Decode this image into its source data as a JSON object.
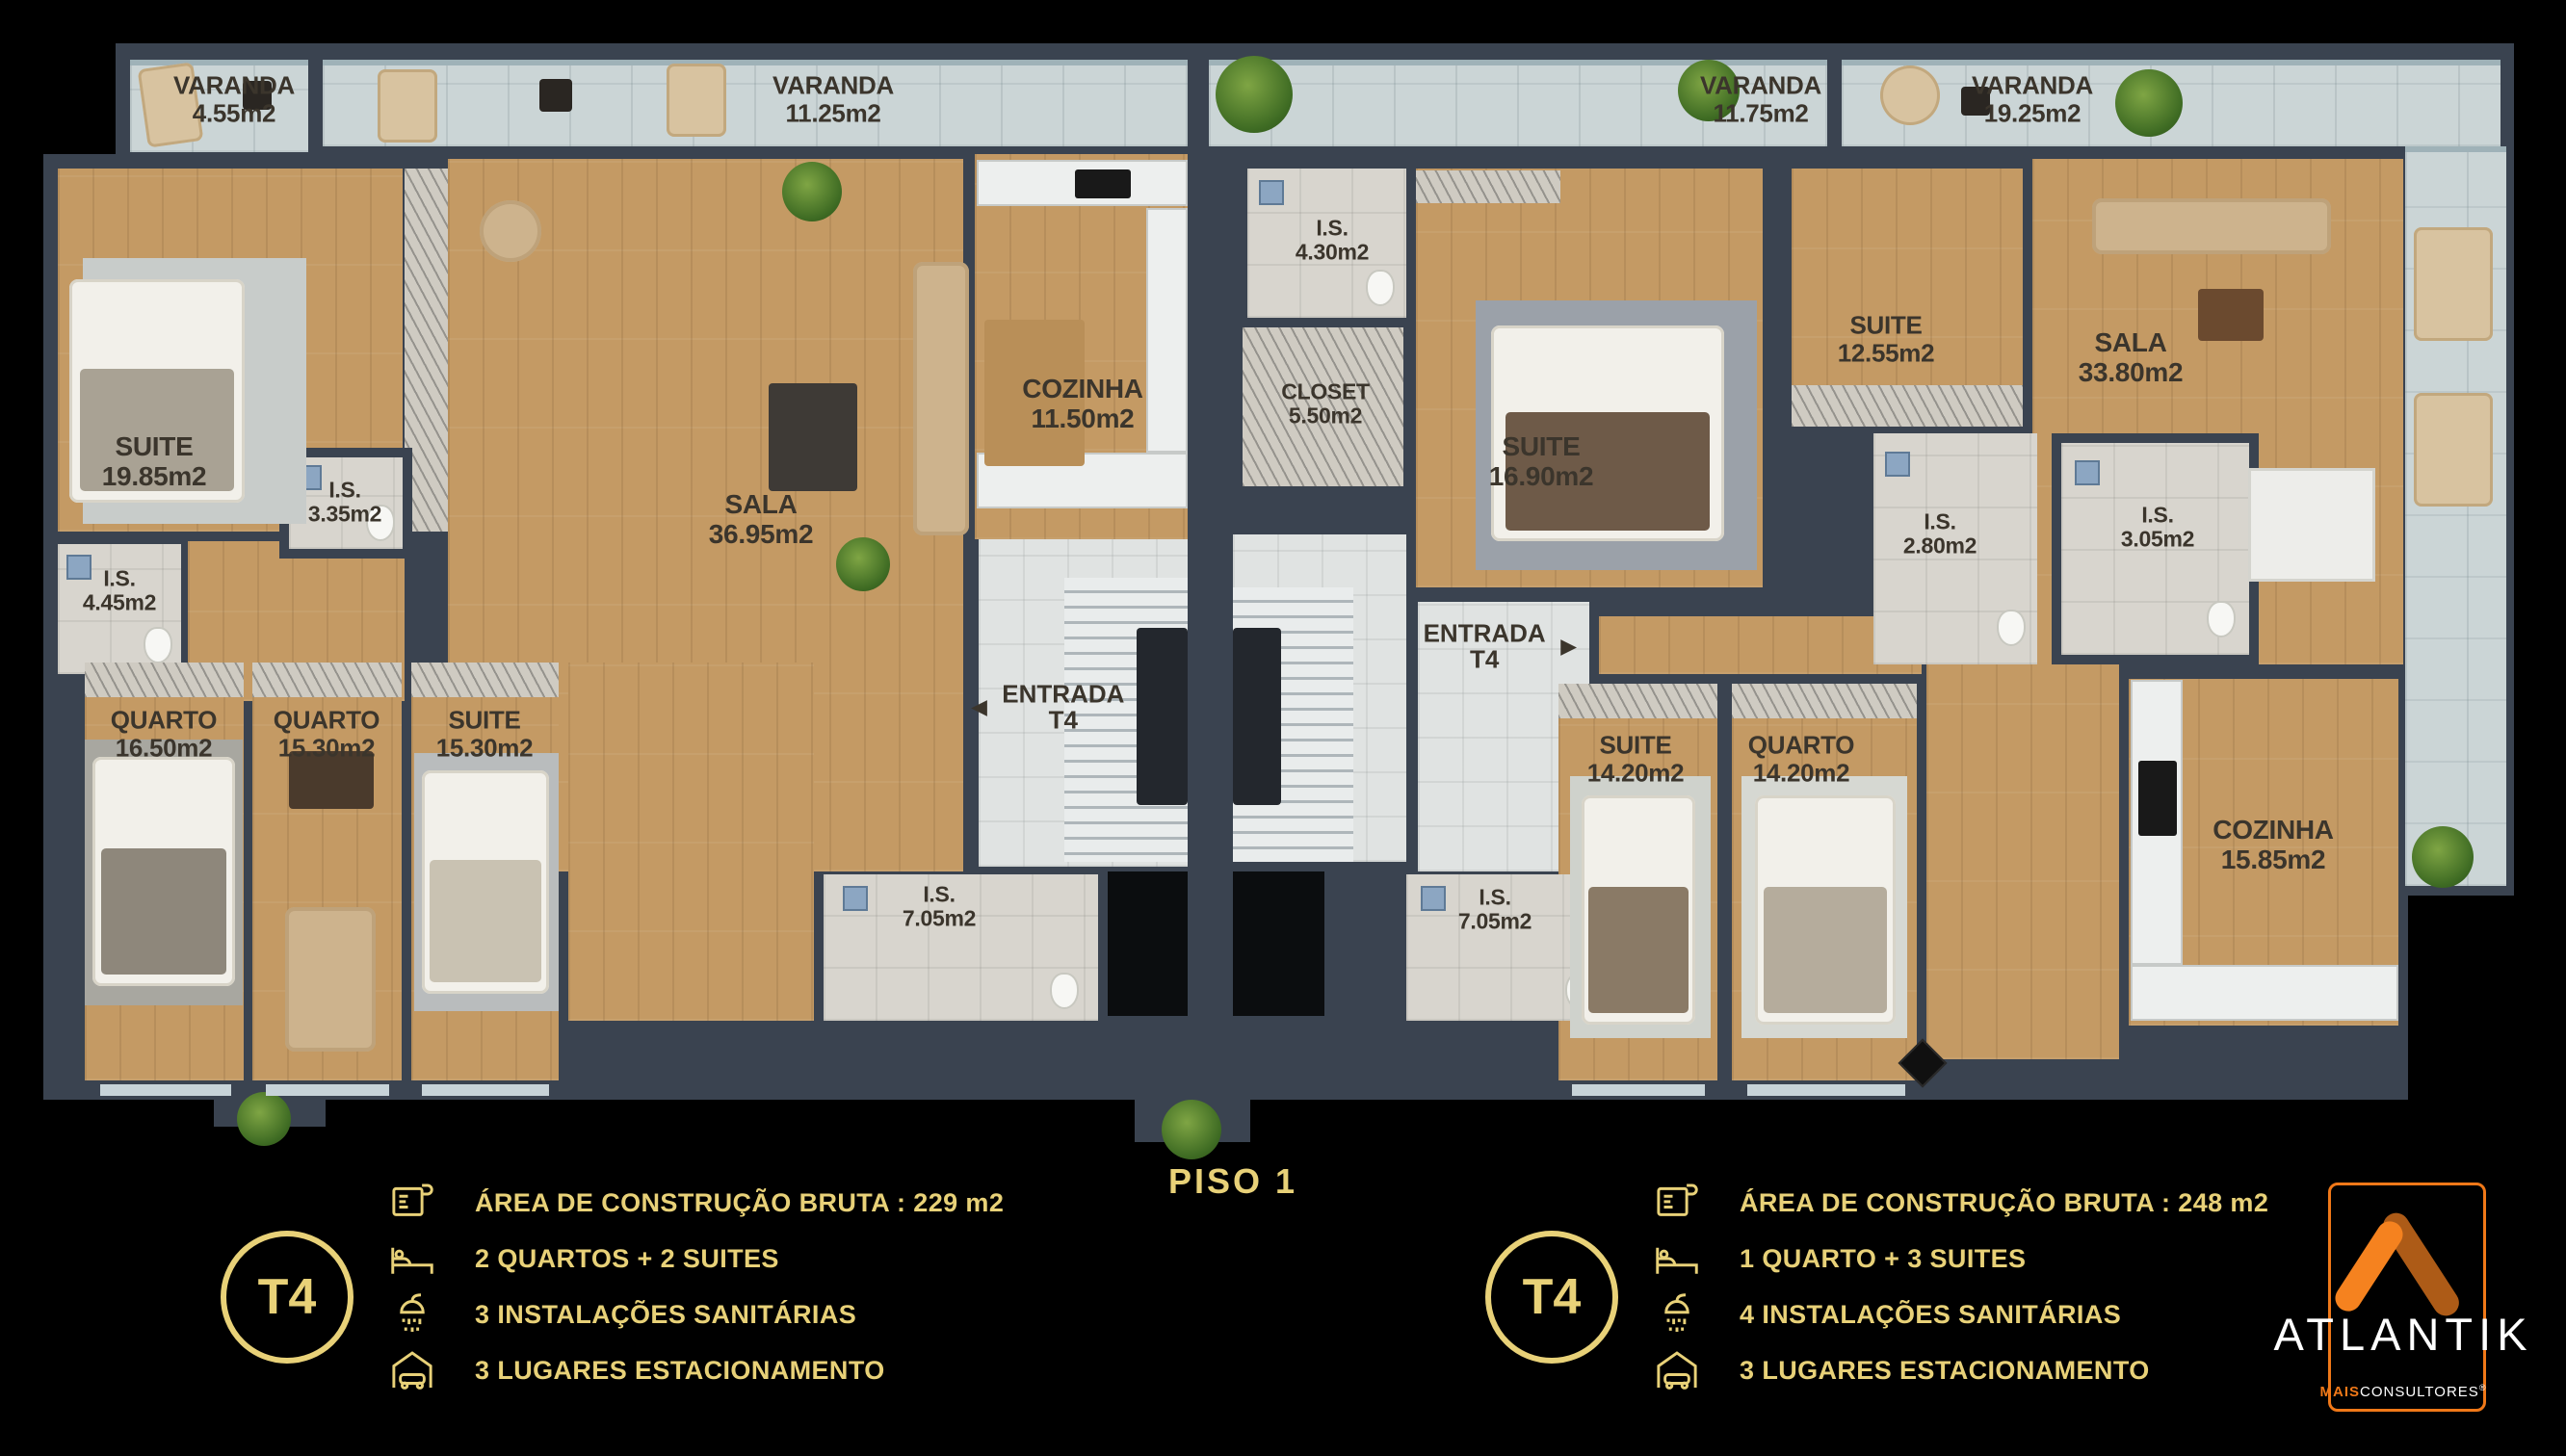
{
  "title": {
    "text": "PISO 1"
  },
  "colors": {
    "gold": "#E8D178",
    "orange": "#F07818",
    "wall": "#3A4350"
  },
  "rooms": [
    {
      "name": "VARANDA",
      "area": "4.55m2"
    },
    {
      "name": "VARANDA",
      "area": "11.25m2"
    },
    {
      "name": "SUITE",
      "area": "19.85m2"
    },
    {
      "name": "I.S.",
      "area": "4.45m2"
    },
    {
      "name": "I.S.",
      "area": "3.35m2"
    },
    {
      "name": "SALA",
      "area": "36.95m2"
    },
    {
      "name": "COZINHA",
      "area": "11.50m2"
    },
    {
      "name": "QUARTO",
      "area": "16.50m2"
    },
    {
      "name": "QUARTO",
      "area": "15.30m2"
    },
    {
      "name": "SUITE",
      "area": "15.30m2"
    },
    {
      "name": "I.S.",
      "area": "7.05m2"
    },
    {
      "name": "I.S.",
      "area": "4.30m2"
    },
    {
      "name": "CLOSET",
      "area": "5.50m2"
    },
    {
      "name": "SUITE",
      "area": "16.90m2"
    },
    {
      "name": "VARANDA",
      "area": "11.75m2"
    },
    {
      "name": "VARANDA",
      "area": "19.25m2"
    },
    {
      "name": "SUITE",
      "area": "12.55m2"
    },
    {
      "name": "I.S.",
      "area": "2.80m2"
    },
    {
      "name": "I.S.",
      "area": "3.05m2"
    },
    {
      "name": "SALA",
      "area": "33.80m2"
    },
    {
      "name": "SUITE",
      "area": "14.20m2"
    },
    {
      "name": "QUARTO",
      "area": "14.20m2"
    },
    {
      "name": "COZINHA",
      "area": "15.85m2"
    },
    {
      "name": "I.S.",
      "area": "7.05m2"
    }
  ],
  "entrances": [
    {
      "label": "ENTRADA",
      "sub": "T4",
      "arrow": "◄"
    },
    {
      "label": "ENTRADA",
      "sub": "T4",
      "arrow": "►"
    }
  ],
  "units": [
    {
      "badge": "T4",
      "specs": [
        {
          "icon": "blueprint-icon",
          "text": "ÁREA DE CONSTRUÇÃO BRUTA :  229 m2"
        },
        {
          "icon": "bed-icon",
          "text": "2 QUARTOS + 2 SUITES"
        },
        {
          "icon": "shower-icon",
          "text": "3 INSTALAÇÕES SANITÁRIAS"
        },
        {
          "icon": "garage-icon",
          "text": "3 LUGARES ESTACIONAMENTO"
        }
      ]
    },
    {
      "badge": "T4",
      "specs": [
        {
          "icon": "blueprint-icon",
          "text": "ÁREA DE CONSTRUÇÃO BRUTA :  248 m2"
        },
        {
          "icon": "bed-icon",
          "text": "1 QUARTO + 3 SUITES"
        },
        {
          "icon": "shower-icon",
          "text": "4 INSTALAÇÕES SANITÁRIAS"
        },
        {
          "icon": "garage-icon",
          "text": "3 LUGARES ESTACIONAMENTO"
        }
      ]
    }
  ],
  "branding": {
    "name": "ATLANTIK",
    "sub_bold": "MAIS",
    "sub_rest": "CONSULTORES",
    "registered": "®"
  }
}
